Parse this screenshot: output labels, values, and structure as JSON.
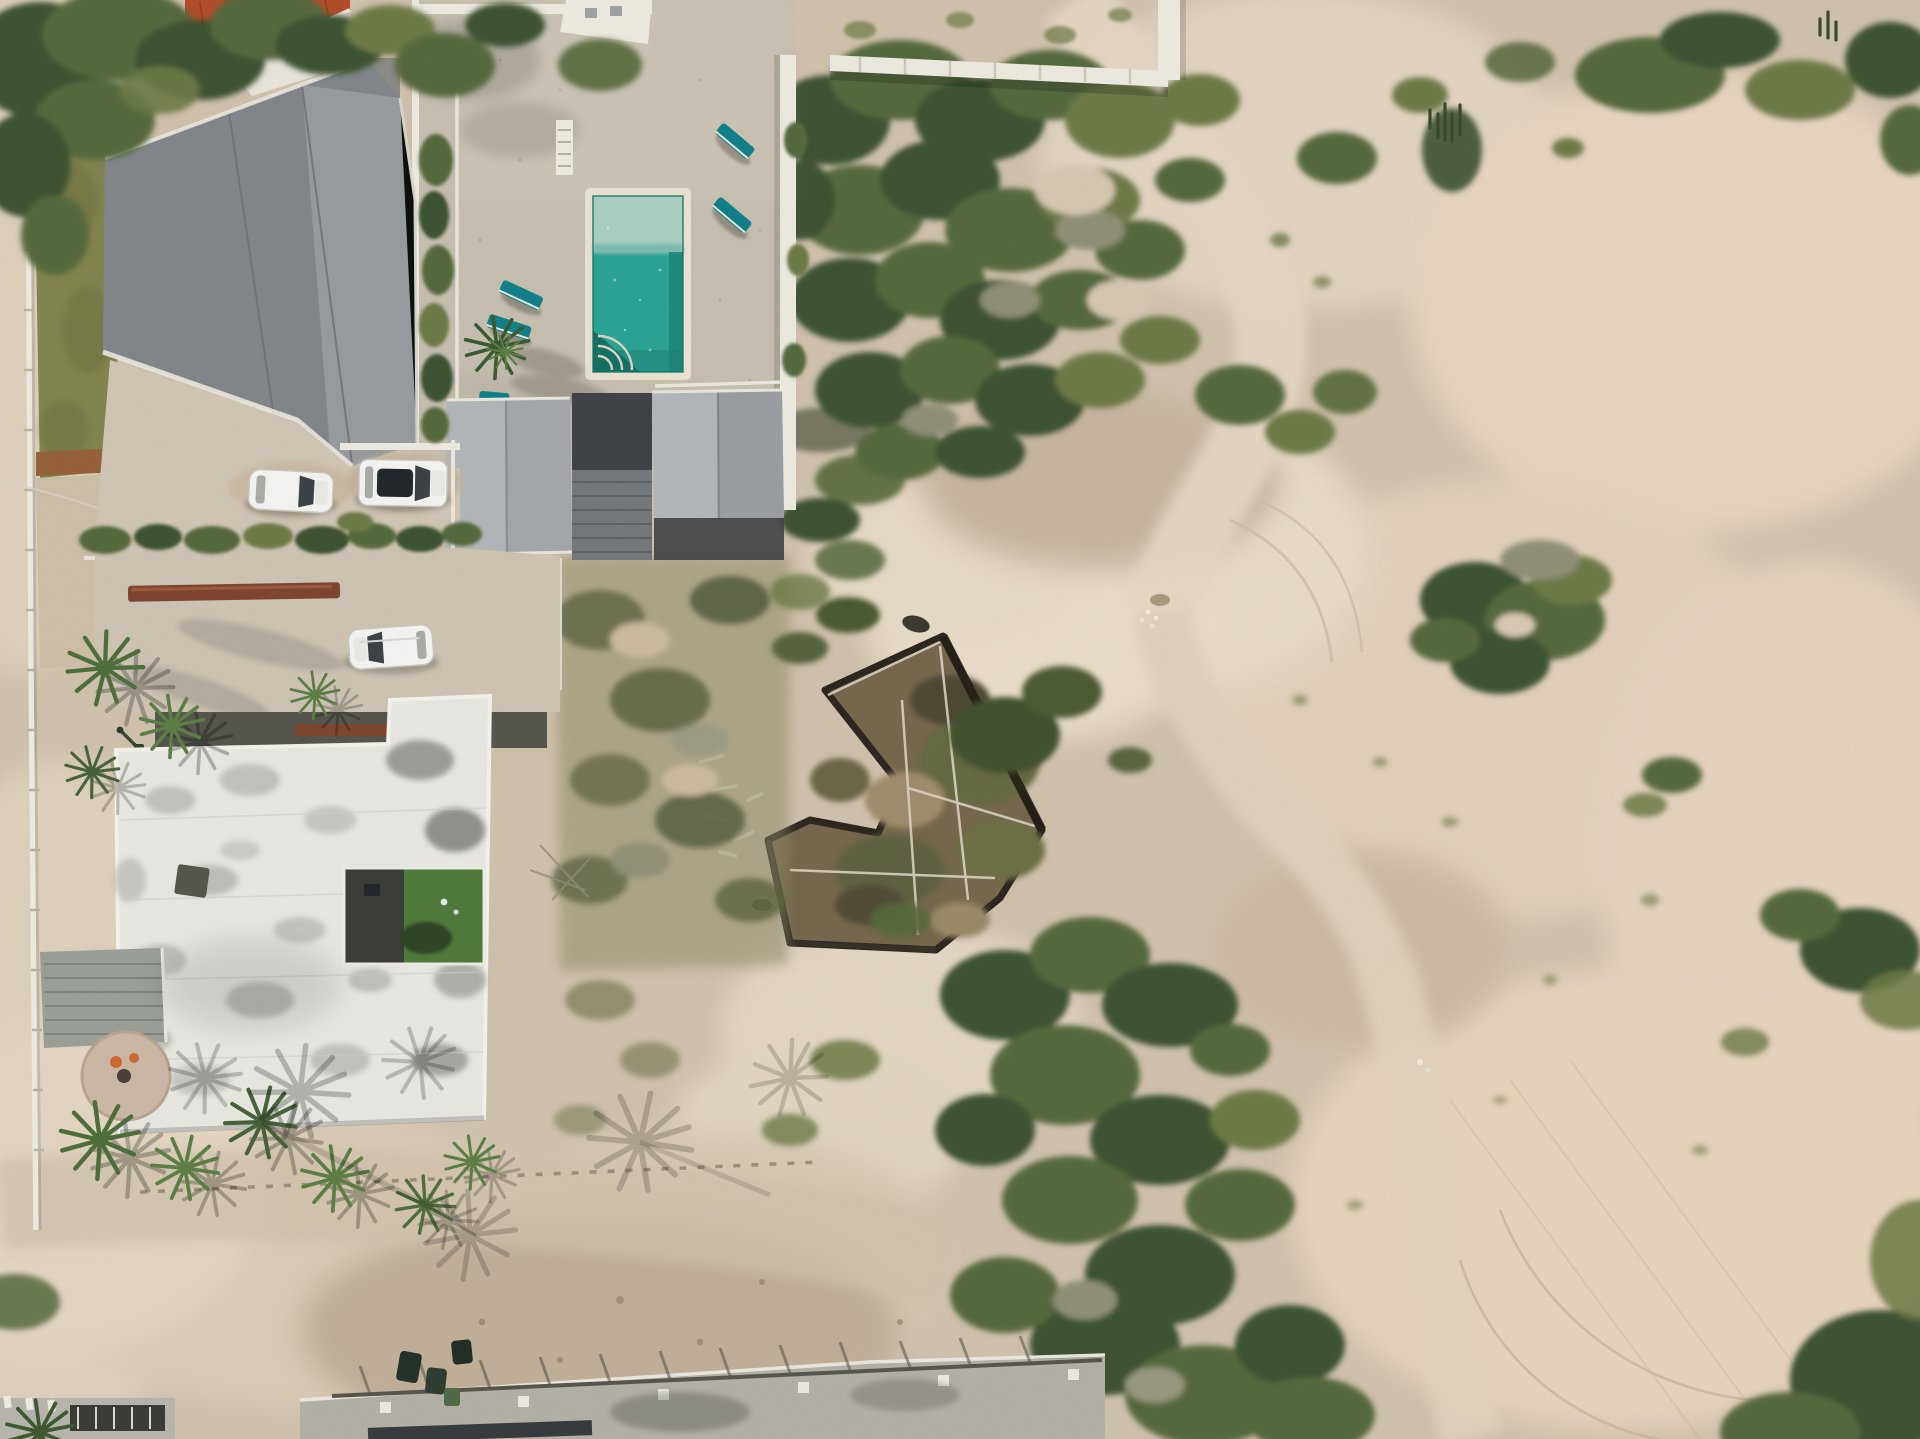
{
  "scene": {
    "type": "aerial-drone-photograph",
    "title": "Aerial top-down view of coastal villas beside a vacant sandy lot",
    "description": "Top-down drone photo: a gray gable-roof villa and a walled pool compound with turquoise pool and teal loungers at top left, a weathered white flat-roof villa with green courtyard below it, three parked white vehicles, palm trees, an abandoned concrete foundation overgrown in the middle, and pale desert sand with scrub bushes, dirt tracks and tire marks to the right and bottom."
  },
  "palette": {
    "sand": "#cfc2ac",
    "sand-light": "#e2d6c2",
    "sand-pink": "#e6d5bf",
    "green-dark": "#3e5232",
    "green-mid": "#56693c",
    "green-olive": "#6d7a47",
    "green-gray": "#8f9076",
    "grass": "#83854f",
    "roof-gray": "#82868a",
    "roof-gray-light": "#989b9e",
    "roof-pale": "#b3b6b8",
    "white-trim": "#eceae0",
    "white-roof": "#e7e7e1",
    "concrete": "#cfc6b5",
    "deck-dark": "#3f4246",
    "pool-water": "#2aa396",
    "pool-shallow": "#a9cfc3",
    "pool-deep": "#1b8377",
    "lounger-teal": "#11808a",
    "red-roof": "#b44c2a",
    "car-white": "#f3f3f1",
    "ruin-floor": "#75684c",
    "ruin-wall": "#2c2721",
    "courtyard-lawn": "#4e7a3b"
  },
  "objects": {
    "vehicles": {
      "white_cars": 2,
      "white_suv": 1,
      "scooter": 1
    },
    "pool": {
      "shape": "rectangular",
      "loungers": 5,
      "steps": "quarter-circle"
    },
    "buildings": [
      {
        "name": "gray-gable-roof-villa"
      },
      {
        "name": "red-tile-roof-house"
      },
      {
        "name": "pool-compound-patio"
      },
      {
        "name": "annex-gable-roofs",
        "count": 2
      },
      {
        "name": "dark-flat-roof"
      },
      {
        "name": "white-flat-roof-villa",
        "courtyard": "artificial-grass"
      },
      {
        "name": "garage-corrugated-roof"
      },
      {
        "name": "abandoned-foundation"
      },
      {
        "name": "bottom-edge-building"
      }
    ],
    "vegetation": {
      "palm_trees": 12,
      "scrub_clusters": "many",
      "hedges": 2
    },
    "ground": {
      "sand": true,
      "dirt_tracks": true,
      "tire_marks": true,
      "stone_row": true
    }
  }
}
